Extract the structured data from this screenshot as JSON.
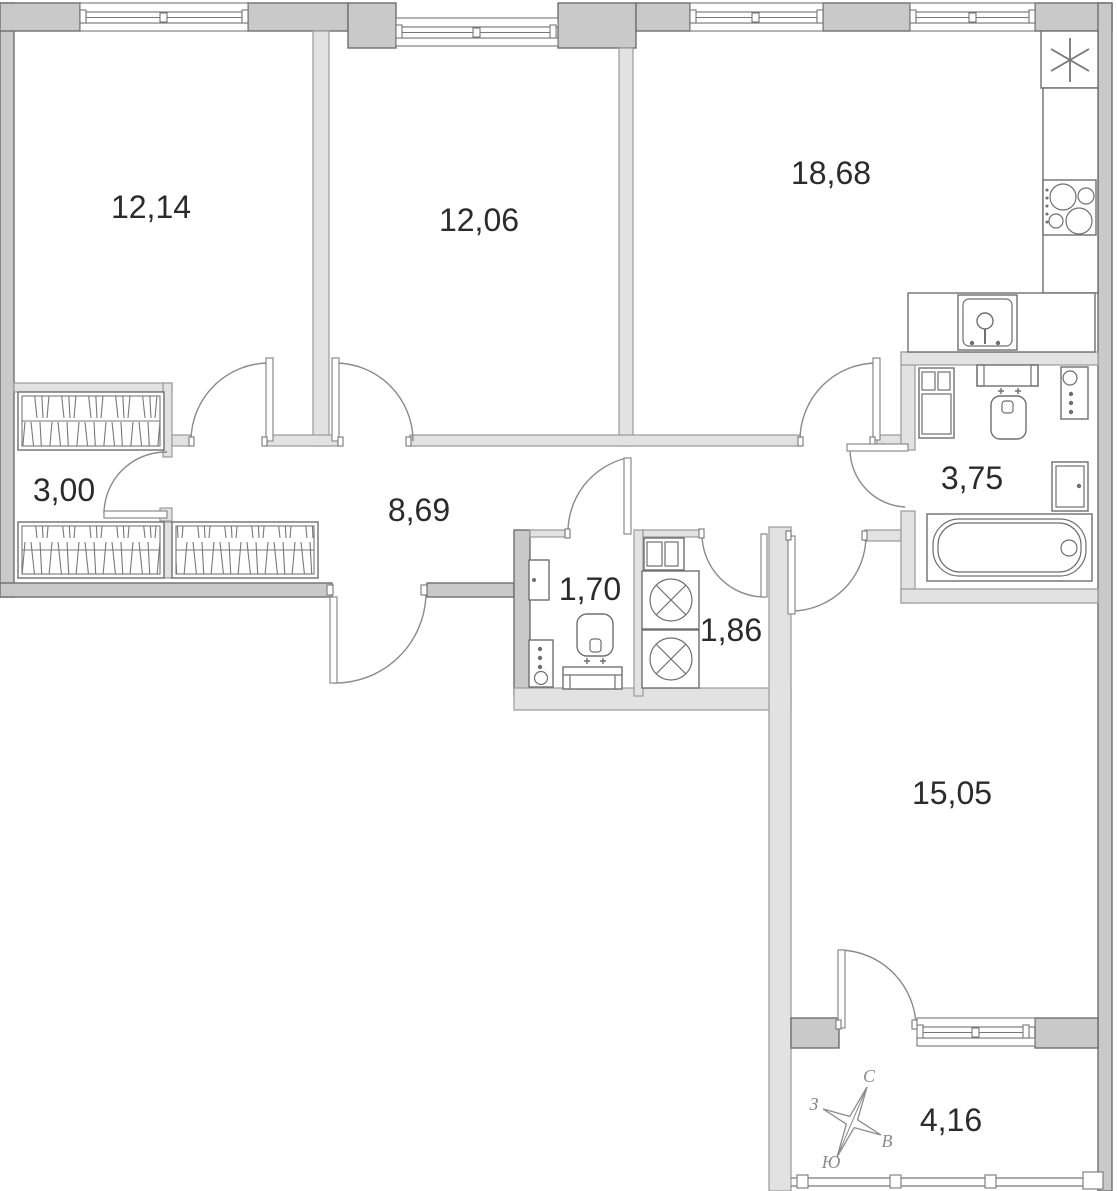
{
  "plan": {
    "title": "apartment-floor-plan",
    "rooms": [
      {
        "id": "bedroom-1",
        "area": "12,14"
      },
      {
        "id": "bedroom-2",
        "area": "12,06"
      },
      {
        "id": "kitchen-living",
        "area": "18,68"
      },
      {
        "id": "wardrobe",
        "area": "3,00"
      },
      {
        "id": "hallway",
        "area": "8,69"
      },
      {
        "id": "wc",
        "area": "1,70"
      },
      {
        "id": "laundry",
        "area": "1,86"
      },
      {
        "id": "bathroom",
        "area": "3,75"
      },
      {
        "id": "bedroom-3",
        "area": "15,05"
      },
      {
        "id": "balcony",
        "area": "4,16"
      }
    ],
    "compass": {
      "north": "С",
      "south": "Ю",
      "west": "З",
      "east": "В"
    },
    "colors": {
      "wall_outer": "#c9c9c9",
      "wall_inner": "#e2e2e2",
      "wall_line": "#6e6e6e",
      "fixture_line": "#6f6f6f",
      "label_text": "#2b2b2b"
    }
  }
}
